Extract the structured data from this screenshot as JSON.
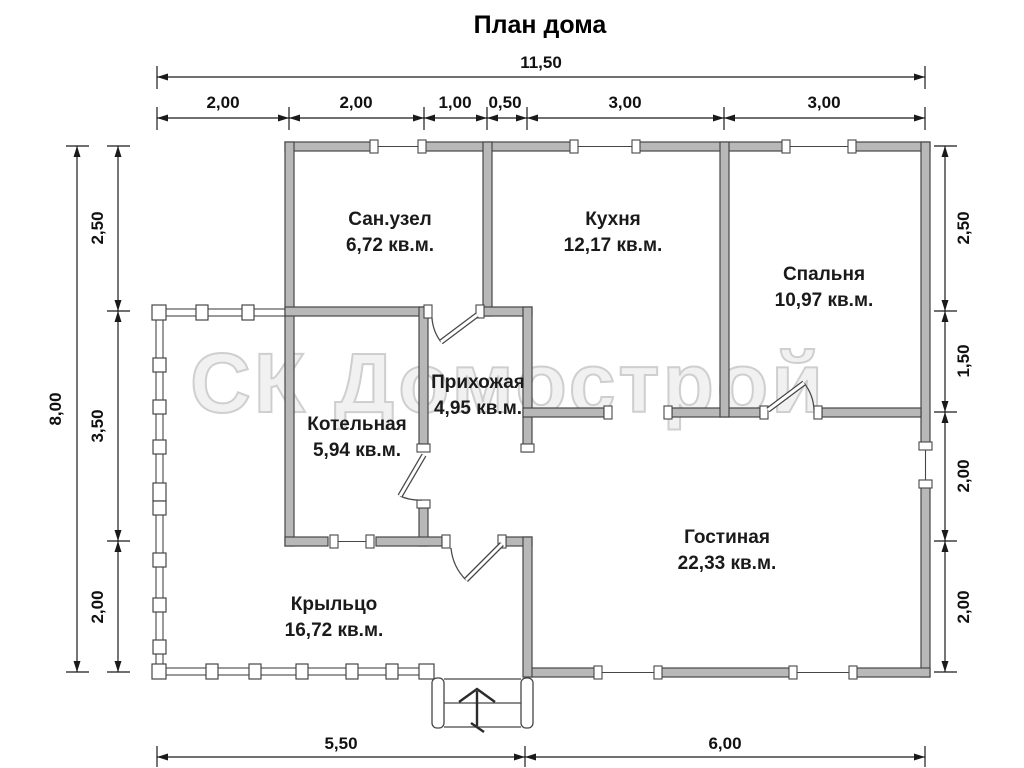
{
  "title": "План дома",
  "watermark": "СК Домострой",
  "rooms": [
    {
      "name": "Сан.узел",
      "area": "6,72 кв.м."
    },
    {
      "name": "Кухня",
      "area": "12,17 кв.м."
    },
    {
      "name": "Спальня",
      "area": "10,97 кв.м."
    },
    {
      "name": "Прихожая",
      "area": "4,95 кв.м."
    },
    {
      "name": "Котельная",
      "area": "5,94 кв.м."
    },
    {
      "name": "Гостиная",
      "area": "22,33 кв.м."
    },
    {
      "name": "Крыльцо",
      "area": "16,72 кв.м."
    }
  ],
  "dimensions": {
    "top_total": "11,50",
    "top_segments": [
      "2,00",
      "2,00",
      "1,00",
      "0,50",
      "3,00",
      "3,00"
    ],
    "left_total": "8,00",
    "left_segments": [
      "2,50",
      "3,50",
      "2,00"
    ],
    "right_segments": [
      "2,50",
      "1,50",
      "2,00",
      "2,00"
    ],
    "bottom_segments": [
      "5,50",
      "6,00"
    ]
  },
  "colors": {
    "background": "#ffffff",
    "wall_fill": "#b8b8b8",
    "wall_outline": "#464646",
    "dimension": "#1a1a1a",
    "watermark": "#d6d6d6"
  }
}
